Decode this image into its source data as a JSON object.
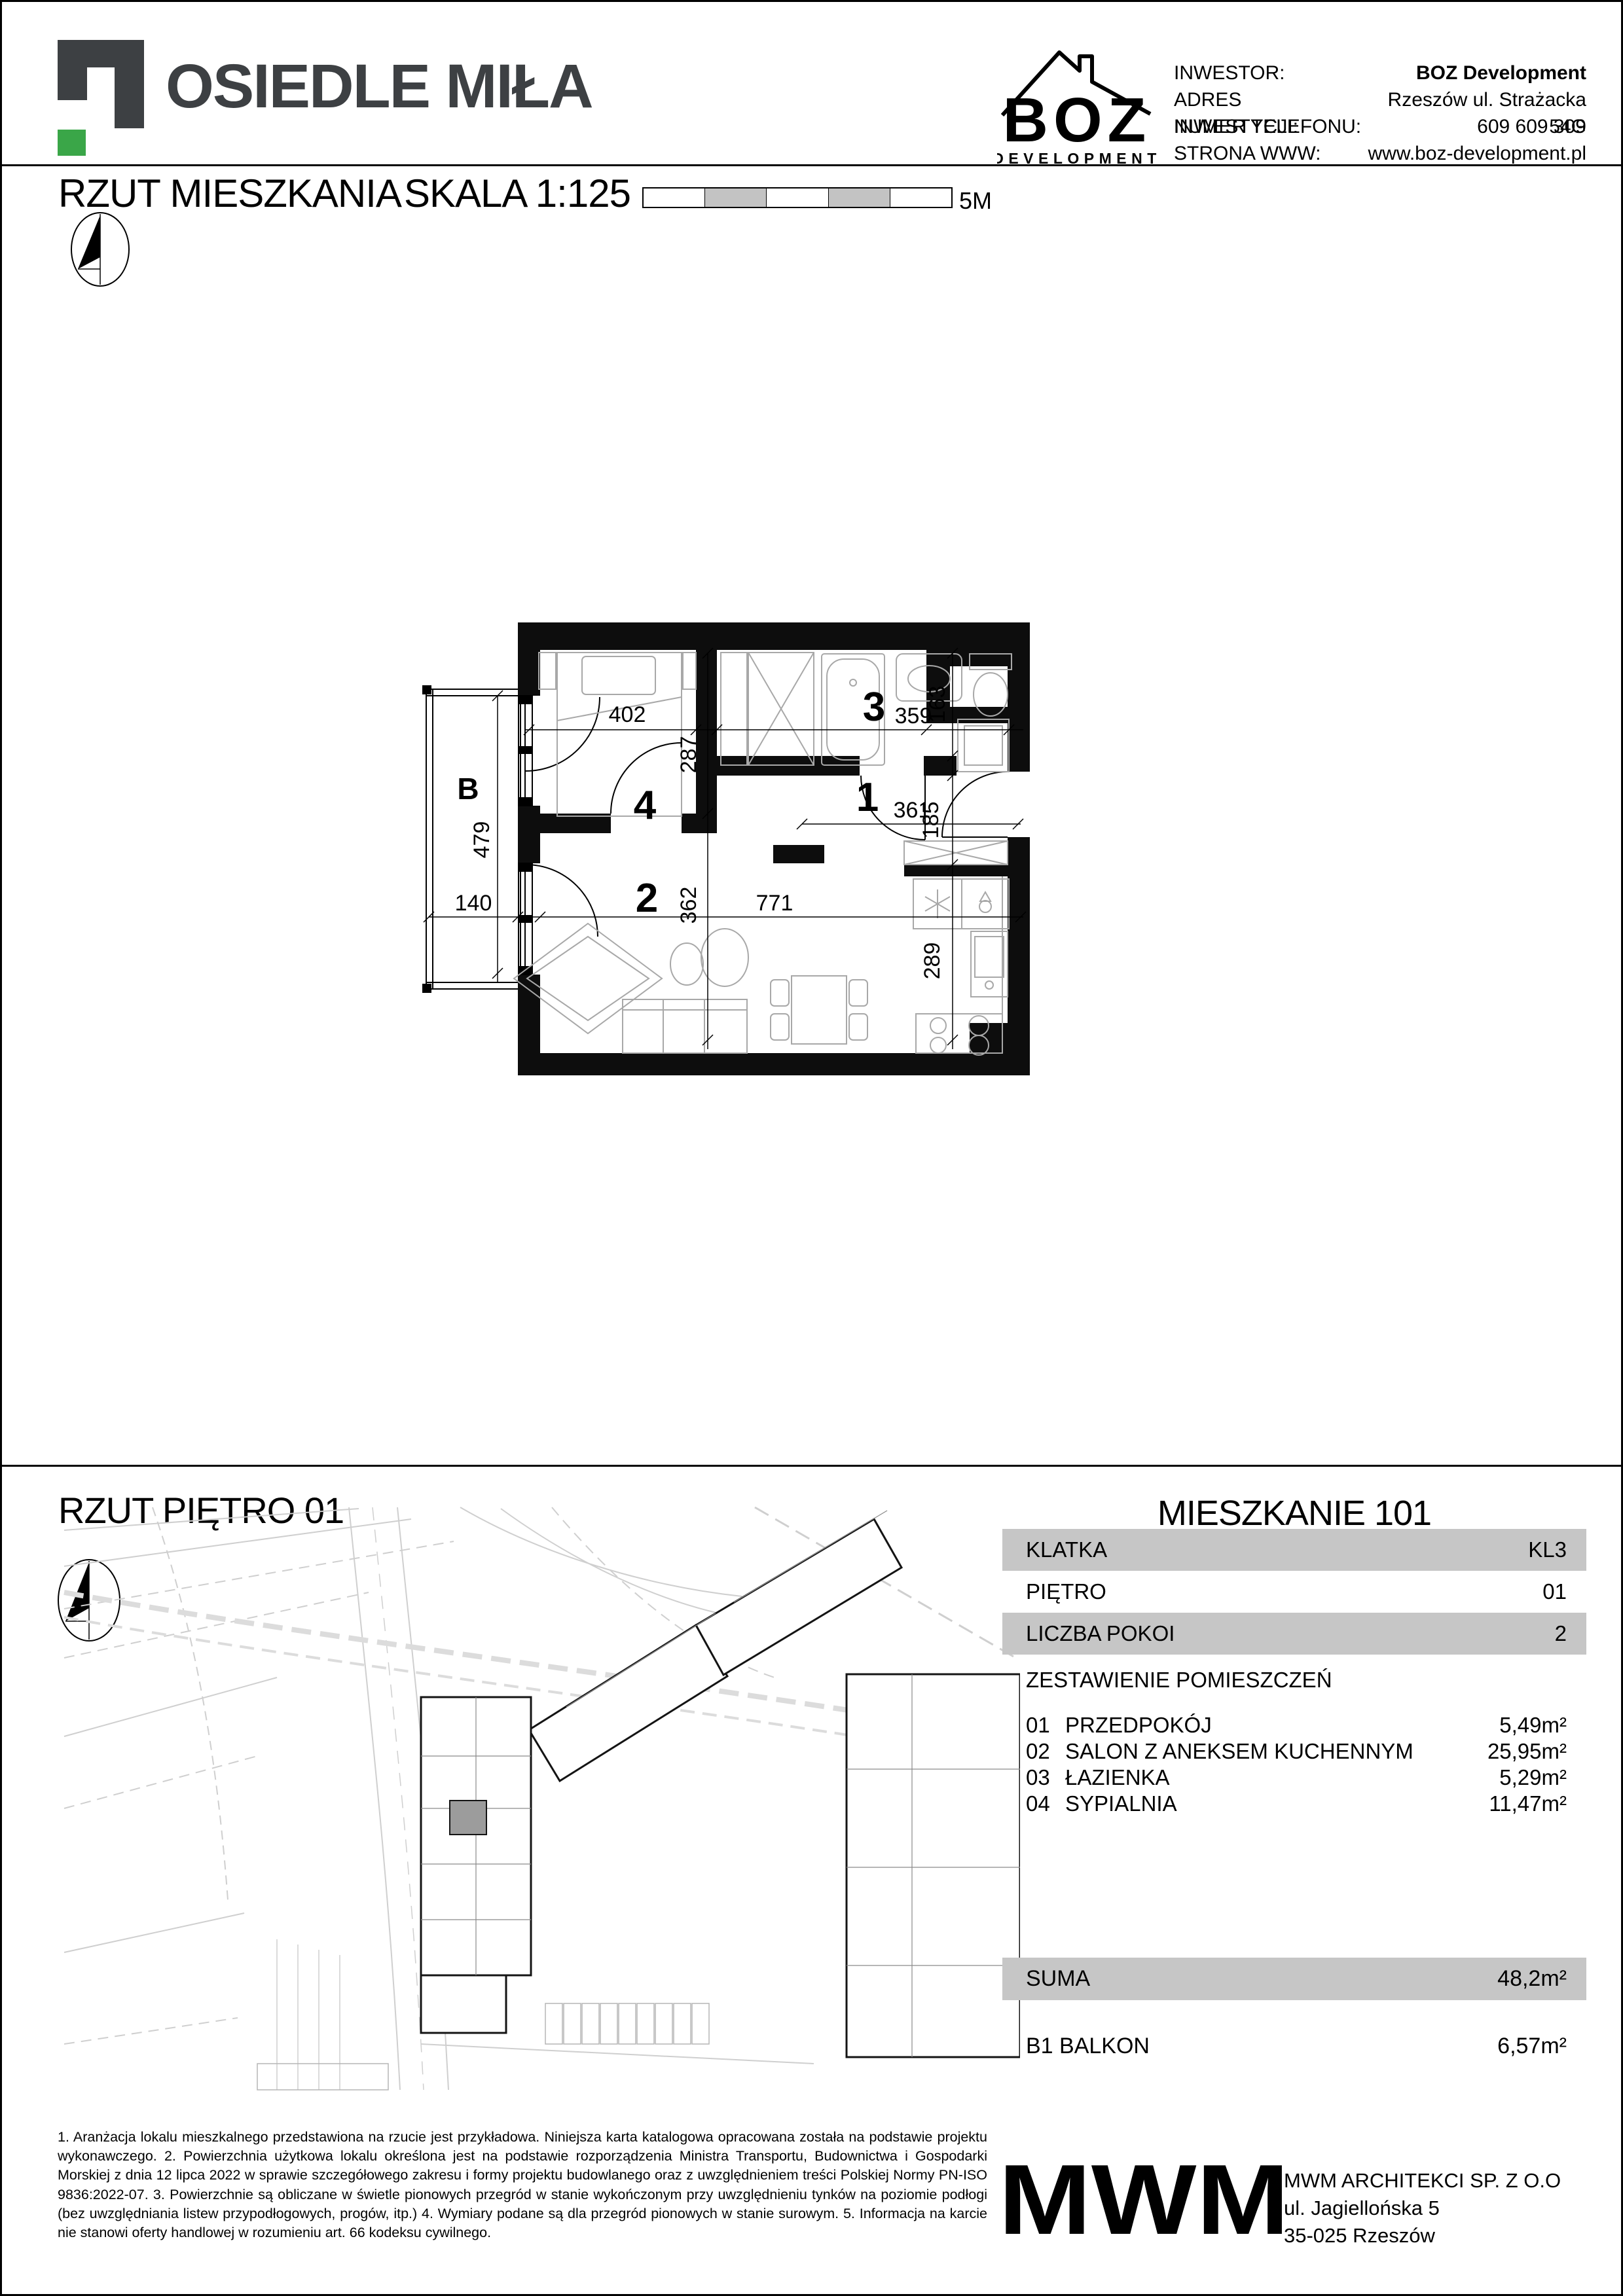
{
  "colors": {
    "accent_green": "#3aa648",
    "logo_gray": "#3d4043",
    "panel_gray": "#c6c6c6",
    "scalebar_gray": "#c3c3c3",
    "map_road_gray": "#cfcfcf",
    "map_unit_gray": "#9c9c9c"
  },
  "header": {
    "project_name": "OSIEDLE MIŁA",
    "developer": {
      "logo_text": "BOZ",
      "logo_subtext": "DEVELOPMENT"
    },
    "contact_rows": [
      {
        "label": "INWESTOR:",
        "value": "BOZ Development"
      },
      {
        "label": "ADRES INWESTYCJI:",
        "value": "Rzeszów ul. Strażacka 54G"
      },
      {
        "label": "NUMER TELEFONU:",
        "value": "609 609 309"
      },
      {
        "label": "STRONA WWW:",
        "value": "www.boz-development.pl"
      }
    ]
  },
  "plan_section": {
    "title": "RZUT MIESZKANIA",
    "scale_label": "SKALA 1:125",
    "scale_bar_max": "5M",
    "balcony_label": "B",
    "room_numbers": {
      "hall": "1",
      "living": "2",
      "bath": "3",
      "bedroom": "4"
    },
    "dimensions": {
      "bedroom_width": "402",
      "bedroom_depth": "287",
      "bath_width": "359",
      "bath_depth": "163",
      "hall_width": "361",
      "hall_depth": "185",
      "living_depth": "362",
      "living_width": "771",
      "kitchen_depth": "289",
      "balcony_depth": "479",
      "balcony_width": "140"
    }
  },
  "floor_section": {
    "title": "RZUT PIĘTRO  01"
  },
  "apartment": {
    "title": "MIESZKANIE  101",
    "attributes": [
      {
        "label": "KLATKA",
        "value": "KL3"
      },
      {
        "label": "PIĘTRO",
        "value": "01"
      },
      {
        "label": "LICZBA POKOI",
        "value": "2"
      }
    ],
    "rooms_header": "ZESTAWIENIE POMIESZCZEŃ",
    "rooms": [
      {
        "no": "01",
        "name": "PRZEDPOKÓJ",
        "area": "5,49m²"
      },
      {
        "no": "02",
        "name": "SALON Z ANEKSEM KUCHENNYM",
        "area": "25,95m²"
      },
      {
        "no": "03",
        "name": "ŁAZIENKA",
        "area": "5,29m²"
      },
      {
        "no": "04",
        "name": "SYPIALNIA",
        "area": "11,47m²"
      }
    ],
    "total": {
      "label": "SUMA",
      "value": "48,2m²"
    },
    "balcony": {
      "label": "B1 BALKON",
      "value": "6,57m²"
    }
  },
  "footer": {
    "notes": "1.  Aranżacja  lokalu  mieszkalnego  przedstawiona  na  rzucie  jest  przykładowa.  Niniejsza  karta  katalogowa  opracowana  została  na  podstawie  projektu wykonawczego.  2. Powierzchnia użytkowa lokalu określona jest na podstawie rozporządzenia Ministra  Transportu,  Budownictwa  i  Gospodarki  Morskiej  z  dnia 12 lipca 2022  w  sprawie  szczegółowego  zakresu i formy projektu budowlanego oraz z uwzględnieniem treści Polskiej  Normy  PN-ISO 9836:2022-07. 3.  Powierzchnie  są  obliczane w świetle  pionowych  przegród  w  stanie  wykończonym  przy  uwzględnieniu   tynków na poziomie podłogi (bez uwzględniania listew przypodłogowych, progów, itp.) 4.  Wymiary podane są dla przegród pionowych w stanie surowym. 5.  Informacja na karcie nie stanowi oferty handlowej w rozumieniu art. 66 kodeksu cywilnego.",
    "architect": {
      "logo": "MWM",
      "company": "MWM ARCHITEKCI SP. Z O.O",
      "street": "ul. Jagiellońska 5",
      "city": "35-025 Rzeszów"
    }
  }
}
